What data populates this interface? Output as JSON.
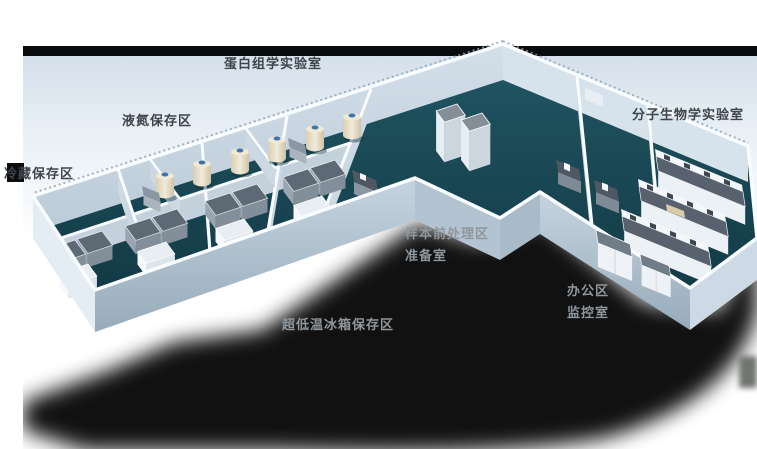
{
  "image": {
    "kind": "3d-isometric-laboratory-floorplan",
    "background": "#ffffff",
    "description": "V-shaped biobank laboratory 3D cutaway render with Chinese area labels"
  },
  "areas": [
    {
      "id": "proteomics",
      "label": "蛋白组学实验室",
      "x": 224,
      "y": 58,
      "tone": "dark"
    },
    {
      "id": "ln2-storage",
      "label": "液氮保存区",
      "x": 122,
      "y": 115,
      "tone": "dark"
    },
    {
      "id": "cold-storage",
      "label": "冷藏保存区",
      "x": 4,
      "y": 168,
      "tone": "dark"
    },
    {
      "id": "molecular-biology",
      "label": "分子生物学实验室",
      "x": 632,
      "y": 109,
      "tone": "dark"
    },
    {
      "id": "sample-pretreatment",
      "label": "样本前处理区",
      "x": 405,
      "y": 228,
      "tone": "light"
    },
    {
      "id": "prep-room",
      "label": "准备室",
      "x": 405,
      "y": 250,
      "tone": "light"
    },
    {
      "id": "office",
      "label": "办公区",
      "x": 567,
      "y": 285,
      "tone": "light"
    },
    {
      "id": "monitor-room",
      "label": "监控室",
      "x": 567,
      "y": 307,
      "tone": "light"
    },
    {
      "id": "ult-freezer-storage",
      "label": "超低温冰箱保存区",
      "x": 282,
      "y": 319,
      "tone": "light"
    }
  ],
  "equipment": [
    {
      "name": "liquid-nitrogen-tank-icon",
      "count": 6
    },
    {
      "name": "ultra-low-freezer-icon",
      "count": 8
    },
    {
      "name": "storage-cabinet-icon",
      "count": 6
    },
    {
      "name": "sample-fridge-icon",
      "count": 2
    },
    {
      "name": "lab-bench-icon",
      "count": 3
    },
    {
      "name": "instrument-desk-icon",
      "count": 3
    },
    {
      "name": "office-cabinet-icon",
      "count": 2
    }
  ],
  "colors": {
    "floor_teal": "#1a4b57",
    "wall_rim": "#fafdff",
    "wall_face": "#c6d4e0",
    "glow_blue": "#d6e1eb",
    "top_band": "#0a0b0c",
    "shadow": "#000000",
    "tank_body": "#e9dfc8",
    "tank_cap": "#3f74ad",
    "freezer_top": "#5d6974",
    "bench_top": "#57626e",
    "label_dark": "#3f454b",
    "label_light": "#8f969c"
  }
}
